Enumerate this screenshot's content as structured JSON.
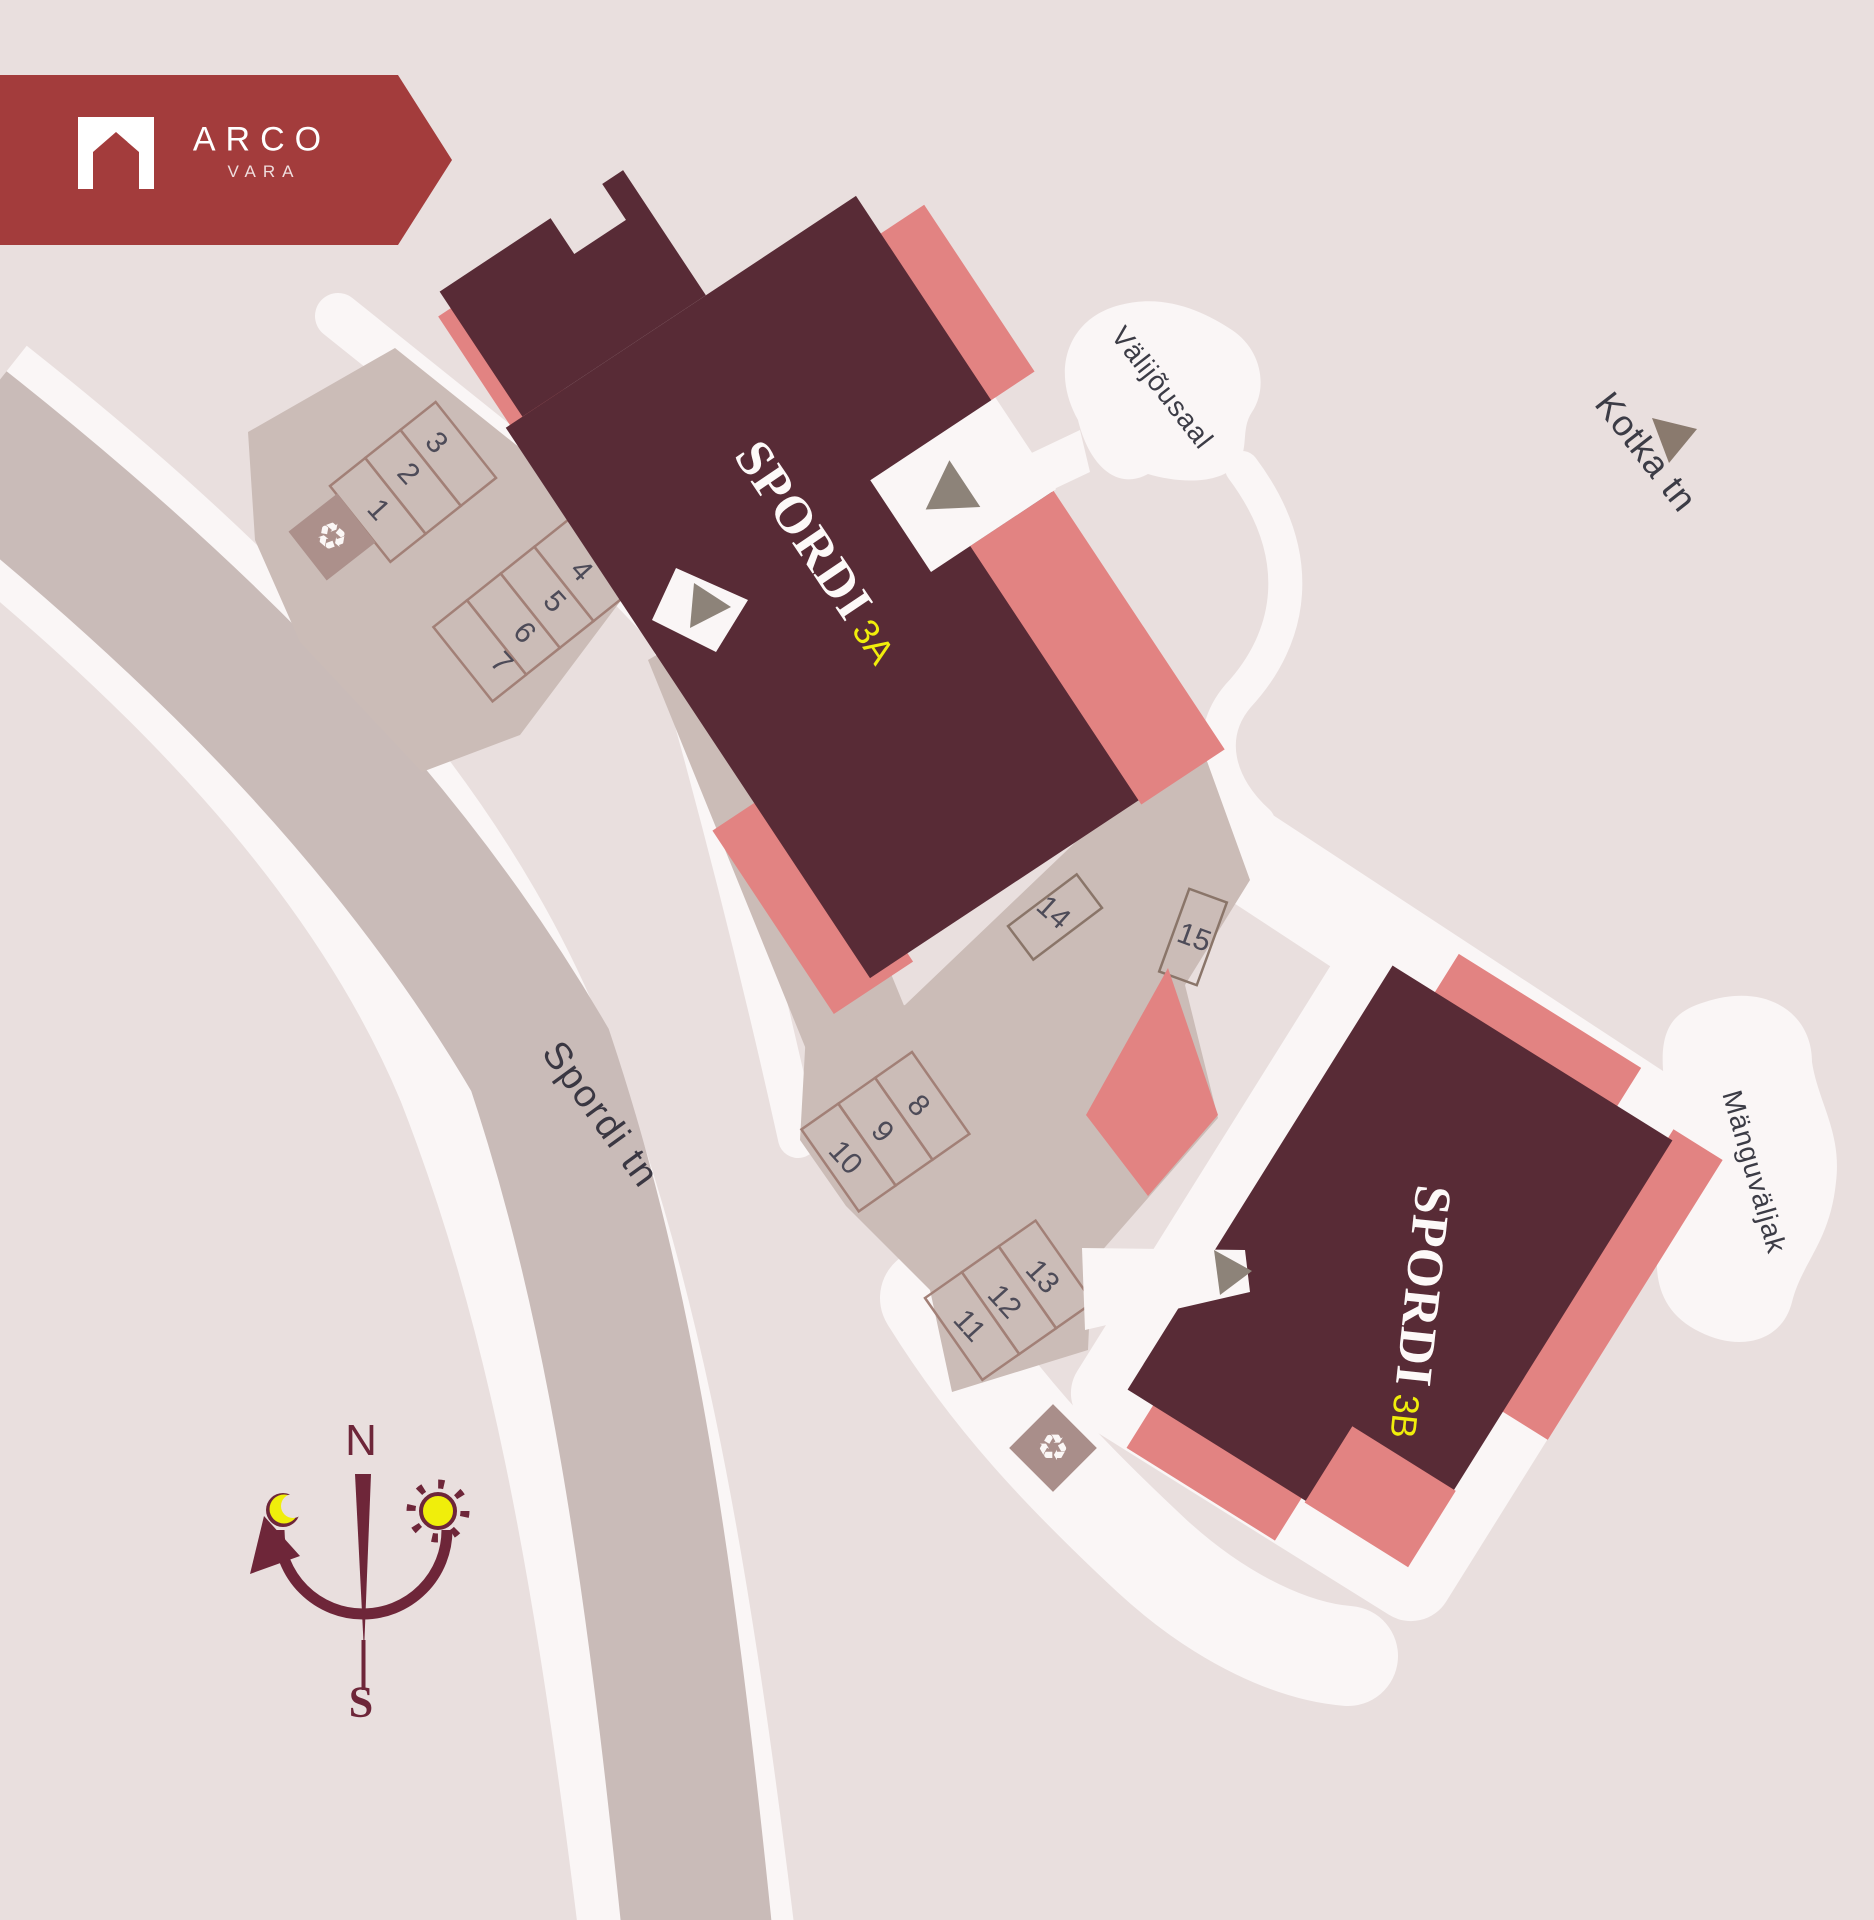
{
  "logo": {
    "brand": "ARCO",
    "subbrand": "VARA"
  },
  "buildings": [
    {
      "name": "SPORDI",
      "unit": "3A"
    },
    {
      "name": "SPORDI",
      "unit": "3B"
    }
  ],
  "streets": {
    "main": "Spordi tn",
    "secondary": "Kotka tn"
  },
  "areas": {
    "outdoor_gym": "Välijõusaal",
    "playground": "Mänguväljak"
  },
  "compass": {
    "north": "N",
    "south": "S"
  },
  "parking": {
    "stalls": [
      "1",
      "2",
      "3",
      "4",
      "5",
      "6",
      "7",
      "8",
      "9",
      "10",
      "11",
      "12",
      "13",
      "14",
      "15"
    ]
  },
  "icons": {
    "recycling": "♻"
  },
  "colors": {
    "background": "#e9dfde",
    "building": "#582b36",
    "accent": "#e28382",
    "brand_red": "#a33c3c",
    "highlight_yellow": "#f0ee0b",
    "path_white": "#faf6f6",
    "road": "#c9bbb8",
    "lot": "#cbbcb7"
  }
}
